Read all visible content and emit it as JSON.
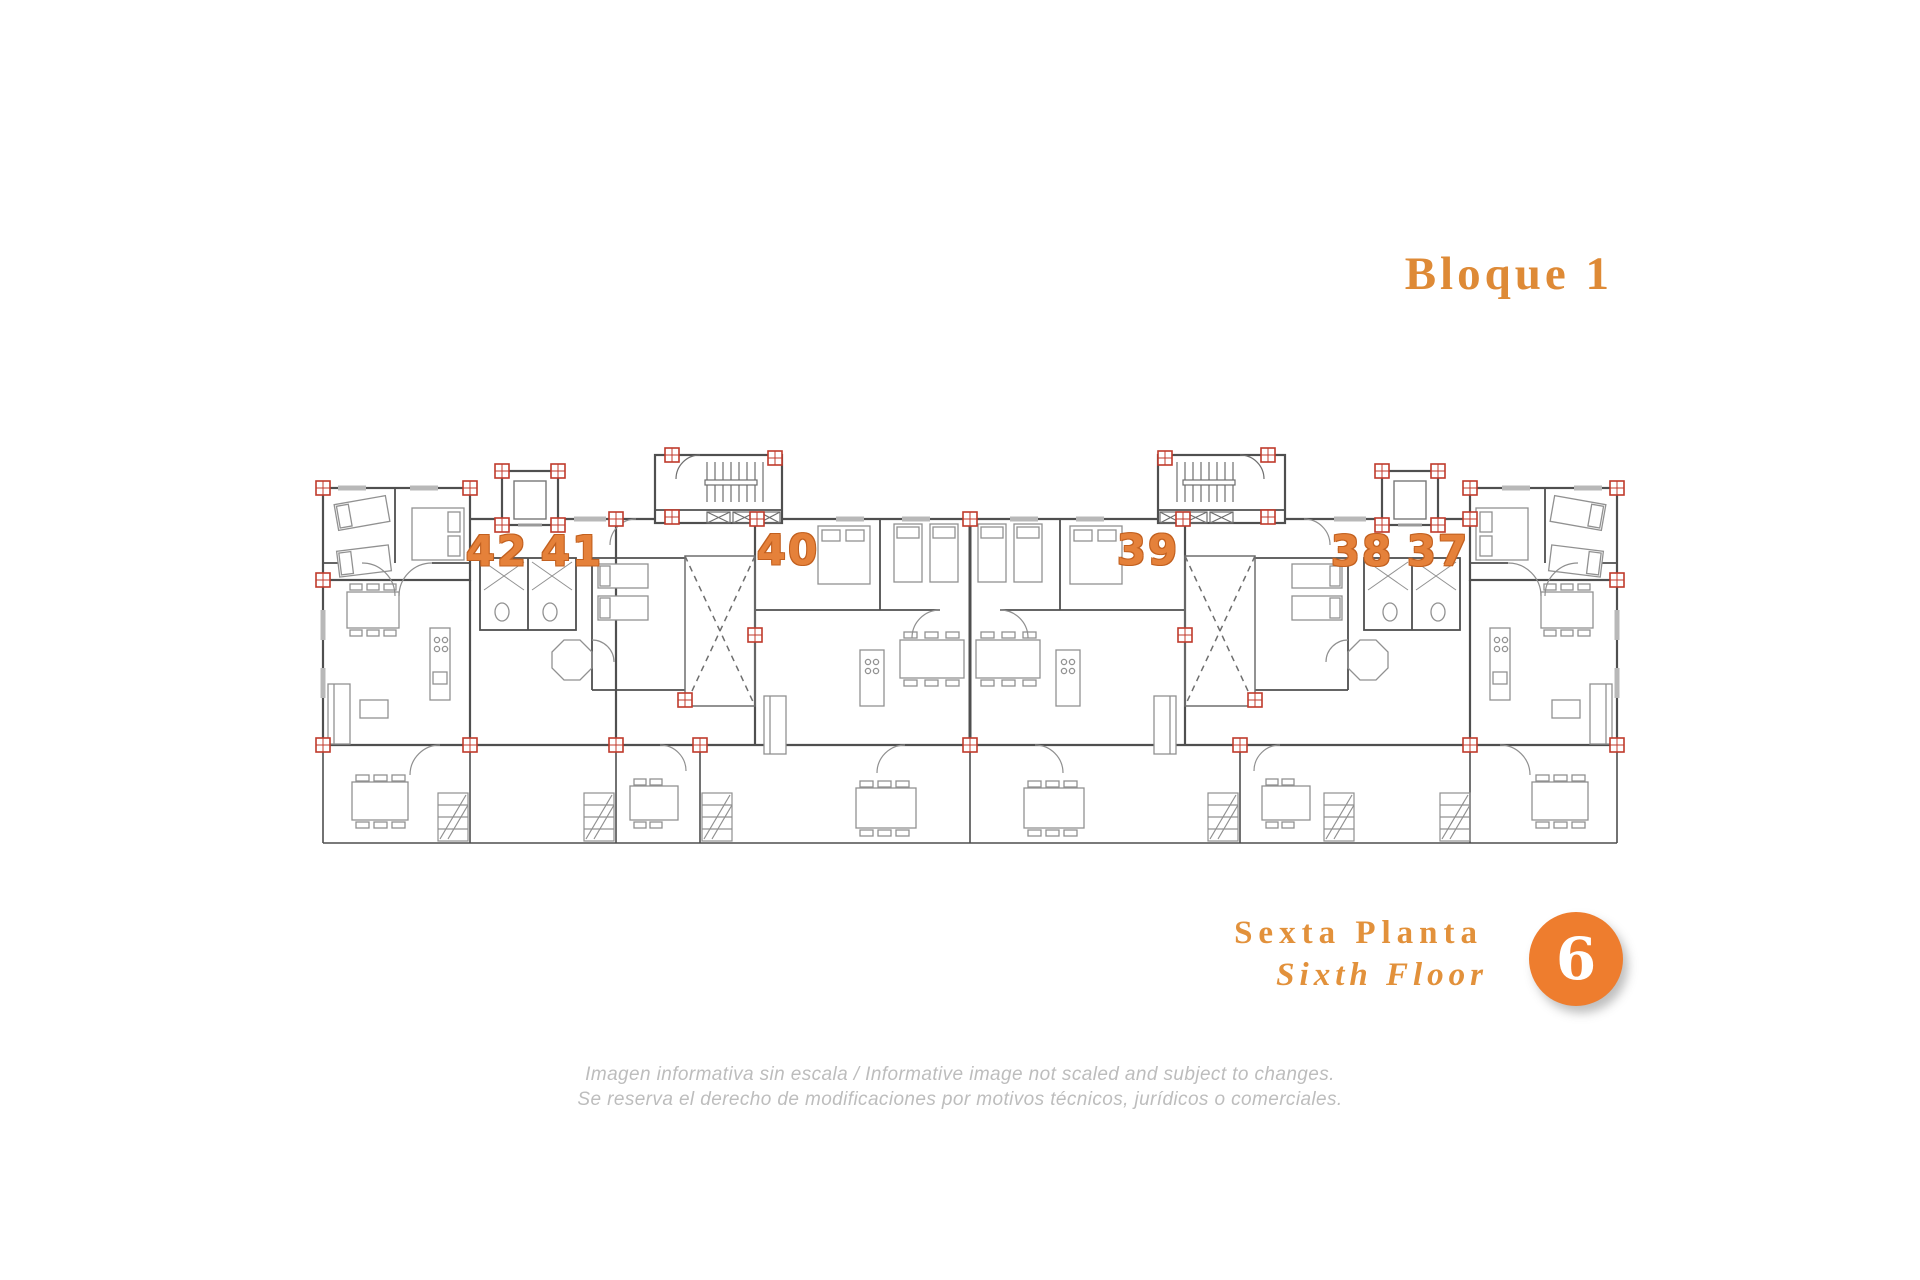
{
  "block_title": "Bloque 1",
  "plan": {
    "apartments": [
      {
        "number": "42"
      },
      {
        "number": "41"
      },
      {
        "number": "40"
      },
      {
        "number": "39"
      },
      {
        "number": "38"
      },
      {
        "number": "37"
      }
    ]
  },
  "floor_label": {
    "es": "Sexta Planta",
    "en": "Sixth Floor",
    "badge": "6"
  },
  "disclaimer": {
    "line1": "Imagen informativa sin escala /  Informative image not scaled and subject to changes.",
    "line2": "Se reserva el derecho de modificaciones por motivos técnicos, jurídicos o comerciales."
  },
  "colors": {
    "accent_orange": "#e5813a",
    "badge_orange": "#ee7d2e",
    "title_orange": "#de8a36",
    "wall_gray": "#4f4f4f",
    "furniture_gray": "#919191",
    "column_red": "#c03a2b"
  }
}
